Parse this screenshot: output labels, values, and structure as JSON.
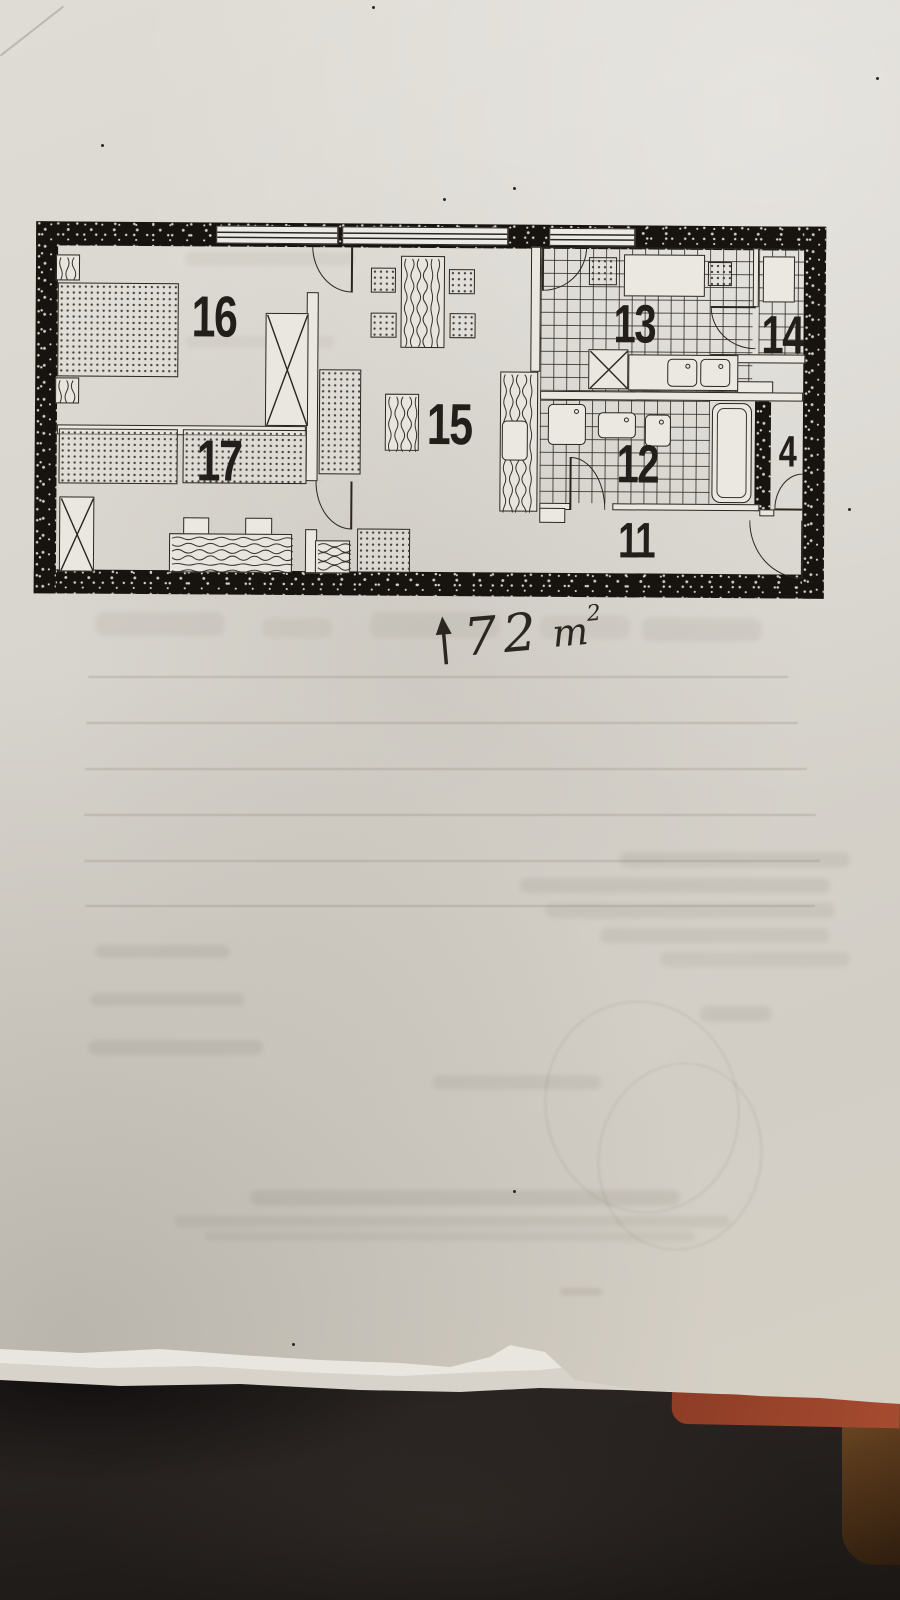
{
  "colors": {
    "paper": "#d8d5ce",
    "paper_light": "#e3e1da",
    "ink": "#29261f",
    "wall_black": "#17140f",
    "fabric_dark": "#1a1715",
    "folder_red": "#8d3c26",
    "wood_brown": "#5a3a1c"
  },
  "plan": {
    "annotation": {
      "arrow": "up",
      "value": "72",
      "unit": "m",
      "exp": "2",
      "full_text": "72 m2"
    },
    "labels": [
      {
        "id": "16",
        "text": "16",
        "x": 156,
        "y": 66,
        "size": 58
      },
      {
        "id": "17",
        "text": "17",
        "x": 162,
        "y": 210,
        "size": 58
      },
      {
        "id": "15",
        "text": "15",
        "x": 392,
        "y": 172,
        "size": 58
      },
      {
        "id": "13",
        "text": "13",
        "x": 578,
        "y": 72,
        "size": 54
      },
      {
        "id": "14",
        "text": "14",
        "x": 726,
        "y": 82,
        "size": 54
      },
      {
        "id": "12",
        "text": "12",
        "x": 582,
        "y": 212,
        "size": 54
      },
      {
        "id": "11",
        "text": "11",
        "x": 584,
        "y": 290,
        "size": 50
      },
      {
        "id": "4",
        "text": "4",
        "x": 744,
        "y": 204,
        "size": 44
      }
    ],
    "geometry": {
      "walls_outer": [
        [
          0,
          0,
          790,
          24
        ],
        [
          0,
          348,
          790,
          24
        ],
        [
          0,
          0,
          22,
          372
        ],
        [
          768,
          0,
          22,
          372
        ],
        [
          720,
          172,
          16,
          113
        ]
      ],
      "windows": [
        [
          180,
          3,
          122,
          18
        ],
        [
          306,
          3,
          166,
          18
        ],
        [
          513,
          3,
          86,
          18
        ]
      ],
      "tiles": [
        [
          505,
          22,
          212,
          144
        ],
        [
          723,
          22,
          45,
          106
        ],
        [
          505,
          175,
          170,
          103
        ]
      ],
      "walls_inner": [
        [
          271,
          69,
          12,
          189
        ],
        [
          271,
          306,
          12,
          44
        ],
        [
          22,
          203,
          249,
          10
        ],
        [
          495,
          22,
          10,
          125
        ],
        [
          505,
          166,
          263,
          9
        ],
        [
          717,
          22,
          6,
          59
        ],
        [
          675,
          128,
          95,
          9
        ],
        [
          505,
          278,
          31,
          7
        ],
        [
          578,
          278,
          147,
          7
        ],
        [
          725,
          283,
          15,
          7
        ]
      ],
      "furniture": [
        {
          "name": "nightstand",
          "kind": "wood",
          "rect": [
            20,
            33,
            24,
            26
          ]
        },
        {
          "name": "double-bed",
          "kind": "dotted",
          "rect": [
            22,
            61,
            121,
            94
          ]
        },
        {
          "name": "nightstand",
          "kind": "wood",
          "rect": [
            20,
            156,
            24,
            26
          ]
        },
        {
          "name": "wardrobe",
          "kind": "xbox",
          "rect": [
            230,
            90,
            43,
            113
          ]
        },
        {
          "name": "bed",
          "kind": "dotted",
          "rect": [
            24,
            207,
            119,
            55
          ]
        },
        {
          "name": "bed",
          "kind": "dotted",
          "rect": [
            148,
            207,
            124,
            54
          ]
        },
        {
          "name": "wardrobe",
          "kind": "xbox",
          "rect": [
            25,
            275,
            35,
            75
          ]
        },
        {
          "name": "desk-chair",
          "kind": "white",
          "rect": [
            149,
            295,
            26,
            18
          ]
        },
        {
          "name": "desk-chair",
          "kind": "white",
          "rect": [
            211,
            295,
            27,
            18
          ]
        },
        {
          "name": "desk",
          "kind": "wood",
          "dir": "h",
          "rect": [
            135,
            311,
            123,
            39
          ]
        },
        {
          "name": "dining-chair",
          "kind": "dotted",
          "rect": [
            335,
            44,
            25,
            25
          ]
        },
        {
          "name": "dining-chair",
          "kind": "dotted",
          "rect": [
            335,
            89,
            26,
            25
          ]
        },
        {
          "name": "dining-chair",
          "kind": "dotted",
          "rect": [
            413,
            45,
            26,
            25
          ]
        },
        {
          "name": "dining-chair",
          "kind": "dotted",
          "rect": [
            414,
            89,
            26,
            25
          ]
        },
        {
          "name": "dining-table",
          "kind": "wood",
          "rect": [
            365,
            32,
            44,
            92
          ]
        },
        {
          "name": "sofa",
          "kind": "dotted",
          "rect": [
            284,
            146,
            42,
            105
          ]
        },
        {
          "name": "coffee-table",
          "kind": "wood",
          "rect": [
            350,
            170,
            34,
            57
          ]
        },
        {
          "name": "cabinet",
          "kind": "wood",
          "rect": [
            465,
            147,
            38,
            140
          ]
        },
        {
          "name": "cabinet-chair",
          "kind": "white",
          "round": true,
          "rect": [
            467,
            196,
            26,
            40
          ]
        },
        {
          "name": "armchair",
          "kind": "dotted",
          "rect": [
            323,
            305,
            53,
            44
          ]
        },
        {
          "name": "magazine-rack",
          "kind": "wavy",
          "rect": [
            281,
            317,
            35,
            33
          ]
        },
        {
          "name": "kitchen-stool",
          "kind": "dotted",
          "rect": [
            553,
            32,
            28,
            28
          ]
        },
        {
          "name": "kitchen-table",
          "kind": "white",
          "rect": [
            588,
            29,
            81,
            42
          ]
        },
        {
          "name": "kitchen-stool",
          "kind": "dotted",
          "rect": [
            672,
            36,
            24,
            24
          ]
        },
        {
          "name": "stove",
          "kind": "xbox",
          "rect": [
            553,
            124,
            40,
            40
          ]
        },
        {
          "name": "kitchen-counter",
          "kind": "white",
          "rect": [
            593,
            129,
            110,
            36
          ]
        },
        {
          "name": "kitchen-sink",
          "kind": "white",
          "round": true,
          "dot": true,
          "rect": [
            632,
            133,
            30,
            28
          ]
        },
        {
          "name": "kitchen-sink",
          "kind": "white",
          "round": true,
          "dot": true,
          "rect": [
            665,
            133,
            30,
            28
          ]
        },
        {
          "name": "shelf",
          "kind": "white",
          "rect": [
            727,
            30,
            32,
            46
          ]
        },
        {
          "name": "shelf",
          "kind": "white",
          "rect": [
            702,
            155,
            36,
            12
          ]
        },
        {
          "name": "bathroom-sink",
          "kind": "white",
          "round": true,
          "dot": true,
          "rect": [
            513,
            179,
            38,
            41
          ]
        },
        {
          "name": "bathroom-sink",
          "kind": "white",
          "round": true,
          "dot": true,
          "rect": [
            563,
            187,
            38,
            26
          ]
        },
        {
          "name": "toilet",
          "kind": "white",
          "round": true,
          "dot": true,
          "rect": [
            610,
            189,
            26,
            32
          ]
        },
        {
          "name": "bathtub",
          "kind": "tub",
          "rect": [
            677,
            177,
            40,
            100
          ]
        },
        {
          "name": "threshold-cabinet",
          "kind": "white",
          "rect": [
            505,
            283,
            26,
            15
          ]
        }
      ],
      "doors": [
        {
          "name": "bedroom-16-door",
          "corner": "bl",
          "leaf": "right",
          "rect": [
            276,
            22,
            40,
            47
          ]
        },
        {
          "name": "bedroom-17-door",
          "corner": "bl",
          "leaf": "right",
          "rect": [
            281,
            258,
            36,
            48
          ]
        },
        {
          "name": "kitchen-door",
          "corner": "br",
          "leaf": "left",
          "rect": [
            507,
            22,
            44,
            44
          ]
        },
        {
          "name": "pantry-door",
          "corner": "bl",
          "leaf": "top",
          "rect": [
            675,
            81,
            45,
            42
          ]
        },
        {
          "name": "bathroom-door",
          "corner": "tr",
          "leaf": "left",
          "rect": [
            536,
            232,
            35,
            53
          ]
        },
        {
          "name": "wc-door",
          "corner": "tl",
          "leaf": "bottom",
          "rect": [
            740,
            247,
            28,
            36
          ]
        },
        {
          "name": "entrance-door",
          "corner": "bl",
          "leaf": "right",
          "rect": [
            715,
            294,
            53,
            58
          ]
        }
      ]
    }
  }
}
